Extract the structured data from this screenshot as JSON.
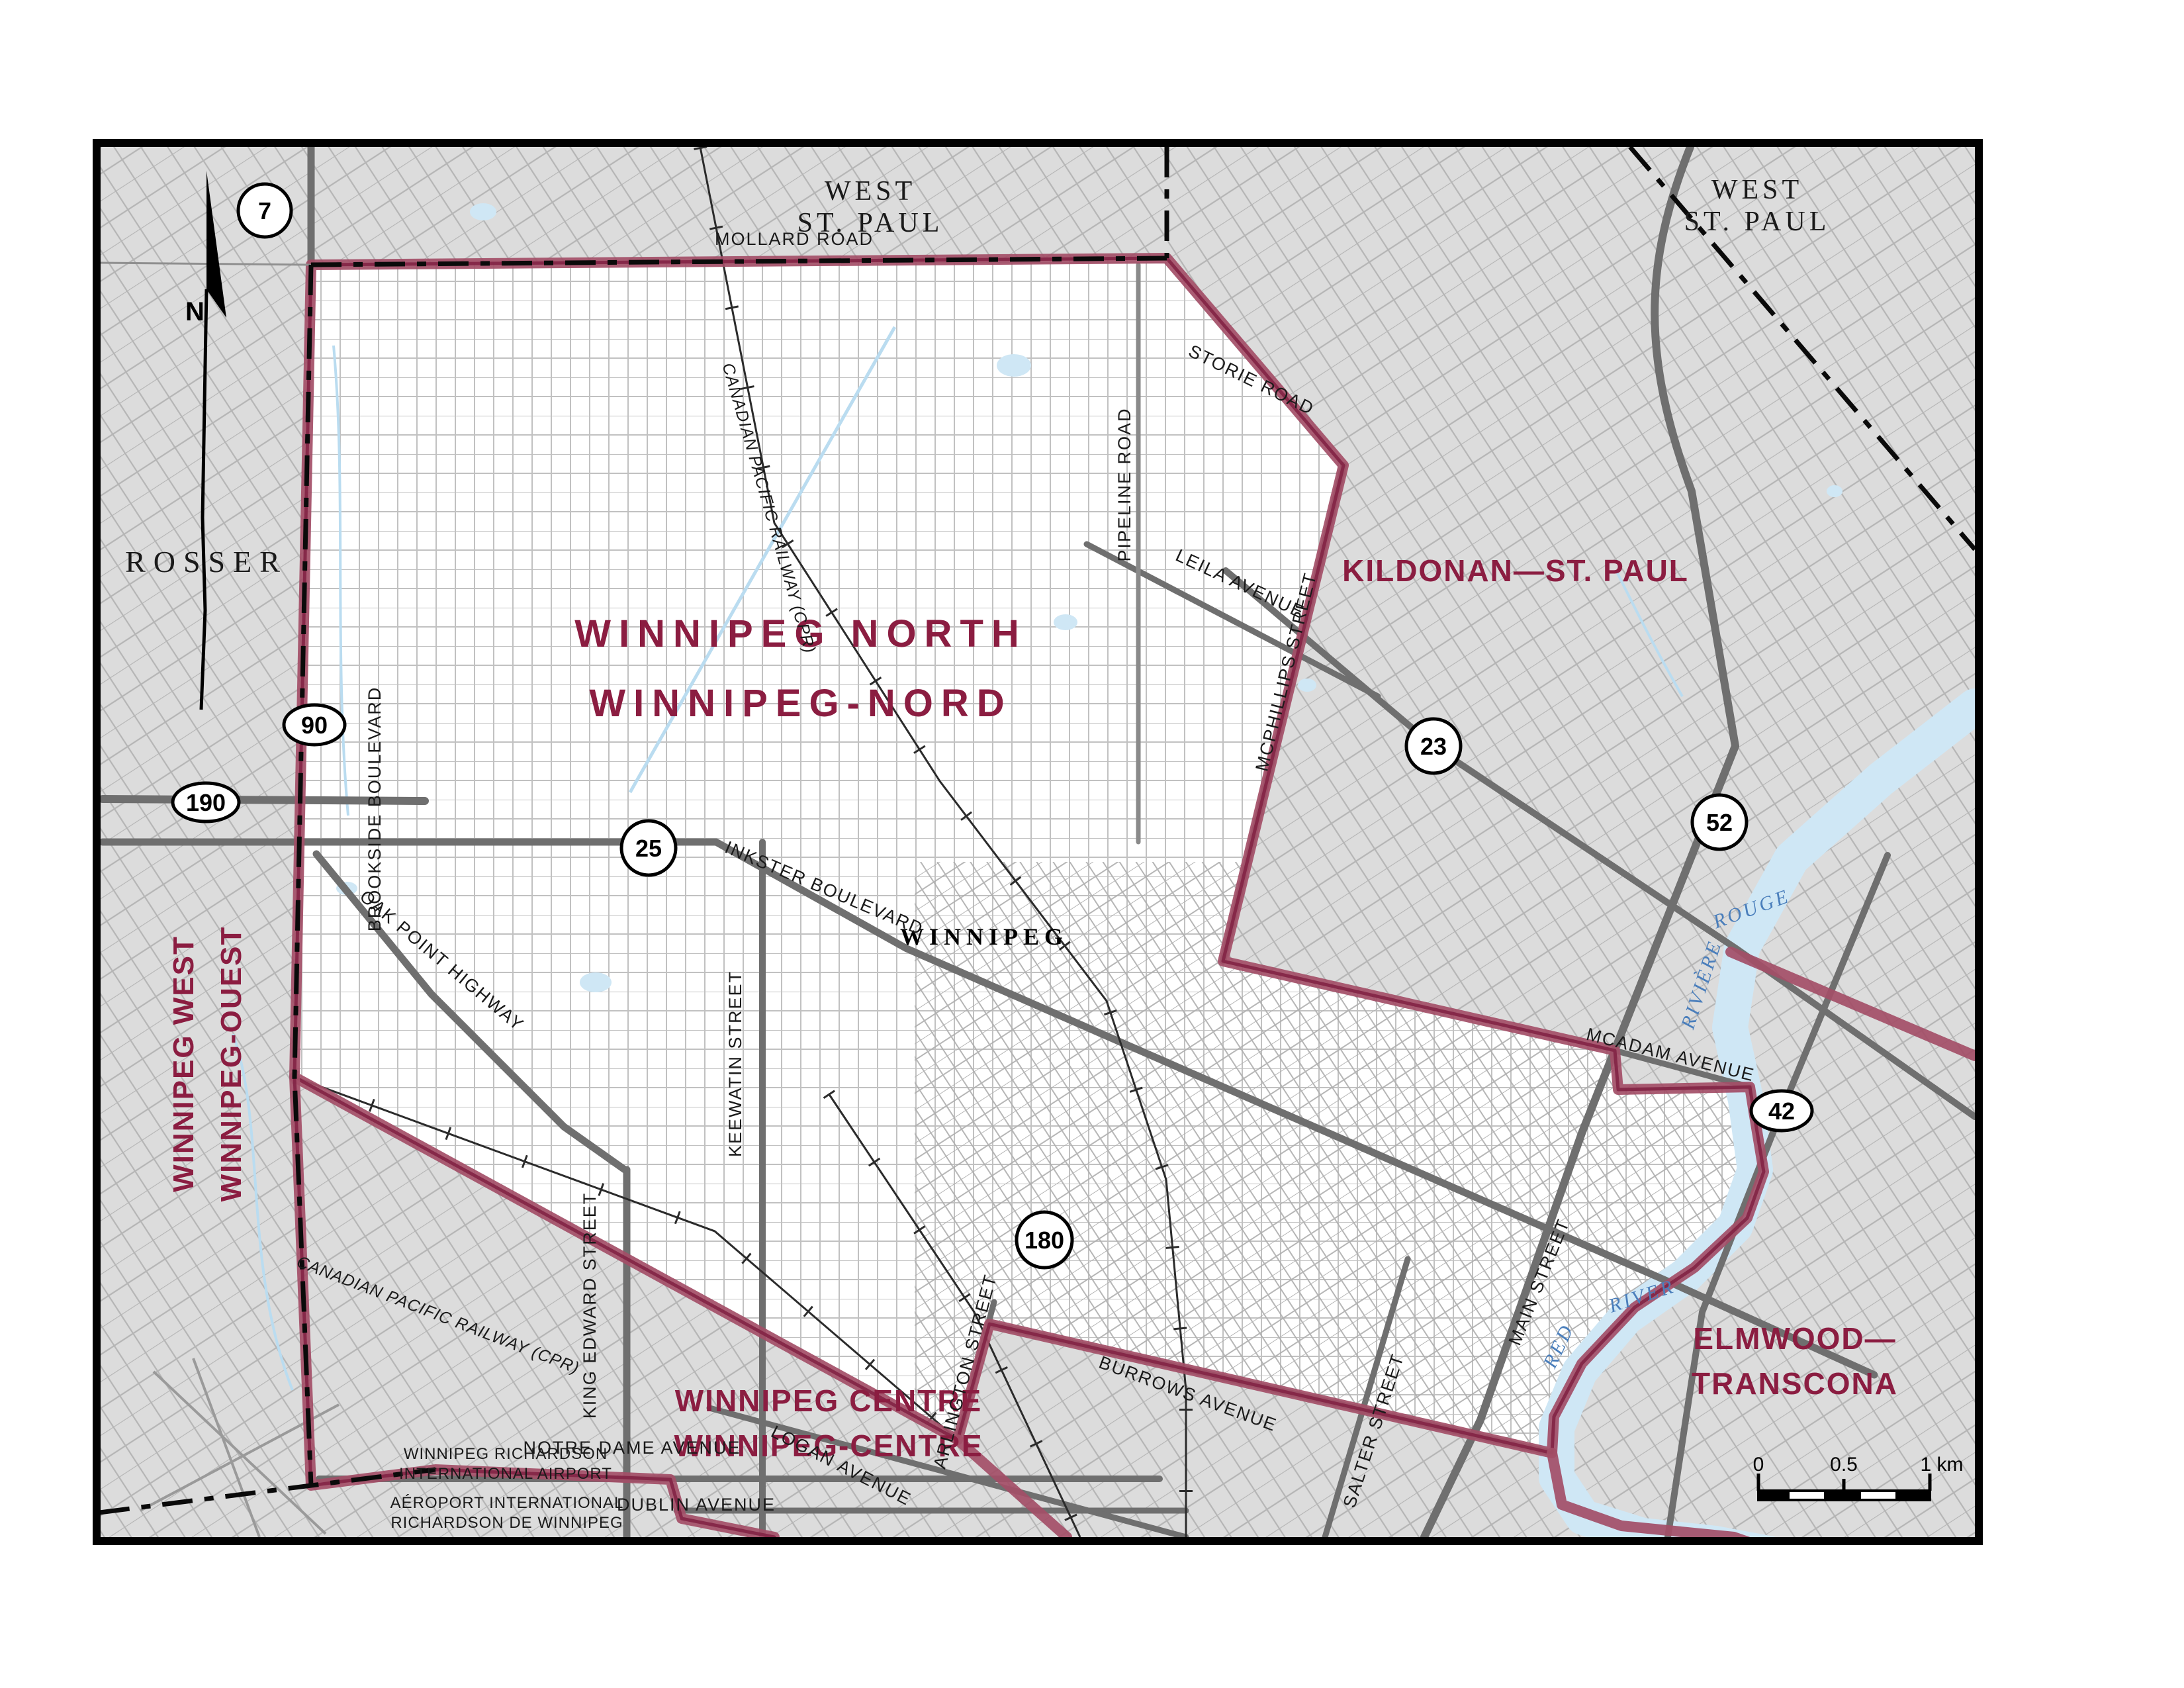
{
  "map": {
    "title_line1": "WINNIPEG NORTH",
    "title_line2": "WINNIPEG-NORD",
    "city": "WINNIPEG",
    "north_letter": "N",
    "districts": {
      "west_st_paul_l1": "WEST",
      "west_st_paul_l2": "ST. PAUL",
      "rosser": "ROSSER",
      "kildonan": "KILDONAN—ST. PAUL",
      "winnipeg_west_en": "WINNIPEG WEST",
      "winnipeg_west_fr": "WINNIPEG-OUEST",
      "winnipeg_centre_en": "WINNIPEG CENTRE",
      "winnipeg_centre_fr": "WINNIPEG-CENTRE",
      "elmwood_l1": "ELMWOOD—",
      "elmwood_l2": "TRANSCONA"
    },
    "roads": {
      "mollard": "MOLLARD ROAD",
      "storie": "STORIE ROAD",
      "pipeline": "PIPELINE ROAD",
      "leila": "LEILA AVENUE",
      "mcphillips": "MCPHILLIPS STREET",
      "brookside": "BROOKSIDE BOULEVARD",
      "inkster": "INKSTER BOULEVARD",
      "oak_point": "OAK POINT HIGHWAY",
      "keewatin": "KEEWATIN STREET",
      "king_edward": "KING EDWARD STREET",
      "notre_dame": "NOTRE DAME AVENUE",
      "dublin": "DUBLIN AVENUE",
      "logan": "LOGAN AVENUE",
      "arlington": "ARLINGTON STREET",
      "burrows": "BURROWS AVENUE",
      "salter": "SALTER STREET",
      "main": "MAIN STREET",
      "mcadam": "MCADAM AVENUE"
    },
    "railway": "CANADIAN PACIFIC RAILWAY (CPR)",
    "water": {
      "riviere": "RIVIÈRE",
      "rouge": "ROUGE",
      "red": "RED",
      "river": "RIVER"
    },
    "airport": {
      "l1": "WINNIPEG RICHARDSON",
      "l2": "INTERNATIONAL AIRPORT",
      "l3": "AÉROPORT INTERNATIONAL",
      "l4": "RICHARDSON DE WINNIPEG"
    },
    "shields": {
      "h7": "7",
      "h90": "90",
      "h190": "190",
      "h25": "25",
      "h23": "23",
      "h52": "52",
      "h42": "42",
      "h180": "180"
    },
    "scalebar": {
      "zero": "0",
      "half": "0.5",
      "one": "1 km"
    },
    "colors": {
      "boundary_maroon": "#9C3A58",
      "district_label_red": "#8B1D41",
      "water_blue": "#CFE7F5",
      "outside_gray": "#DCDCDC",
      "road_gray": "#6F6F6F"
    }
  }
}
